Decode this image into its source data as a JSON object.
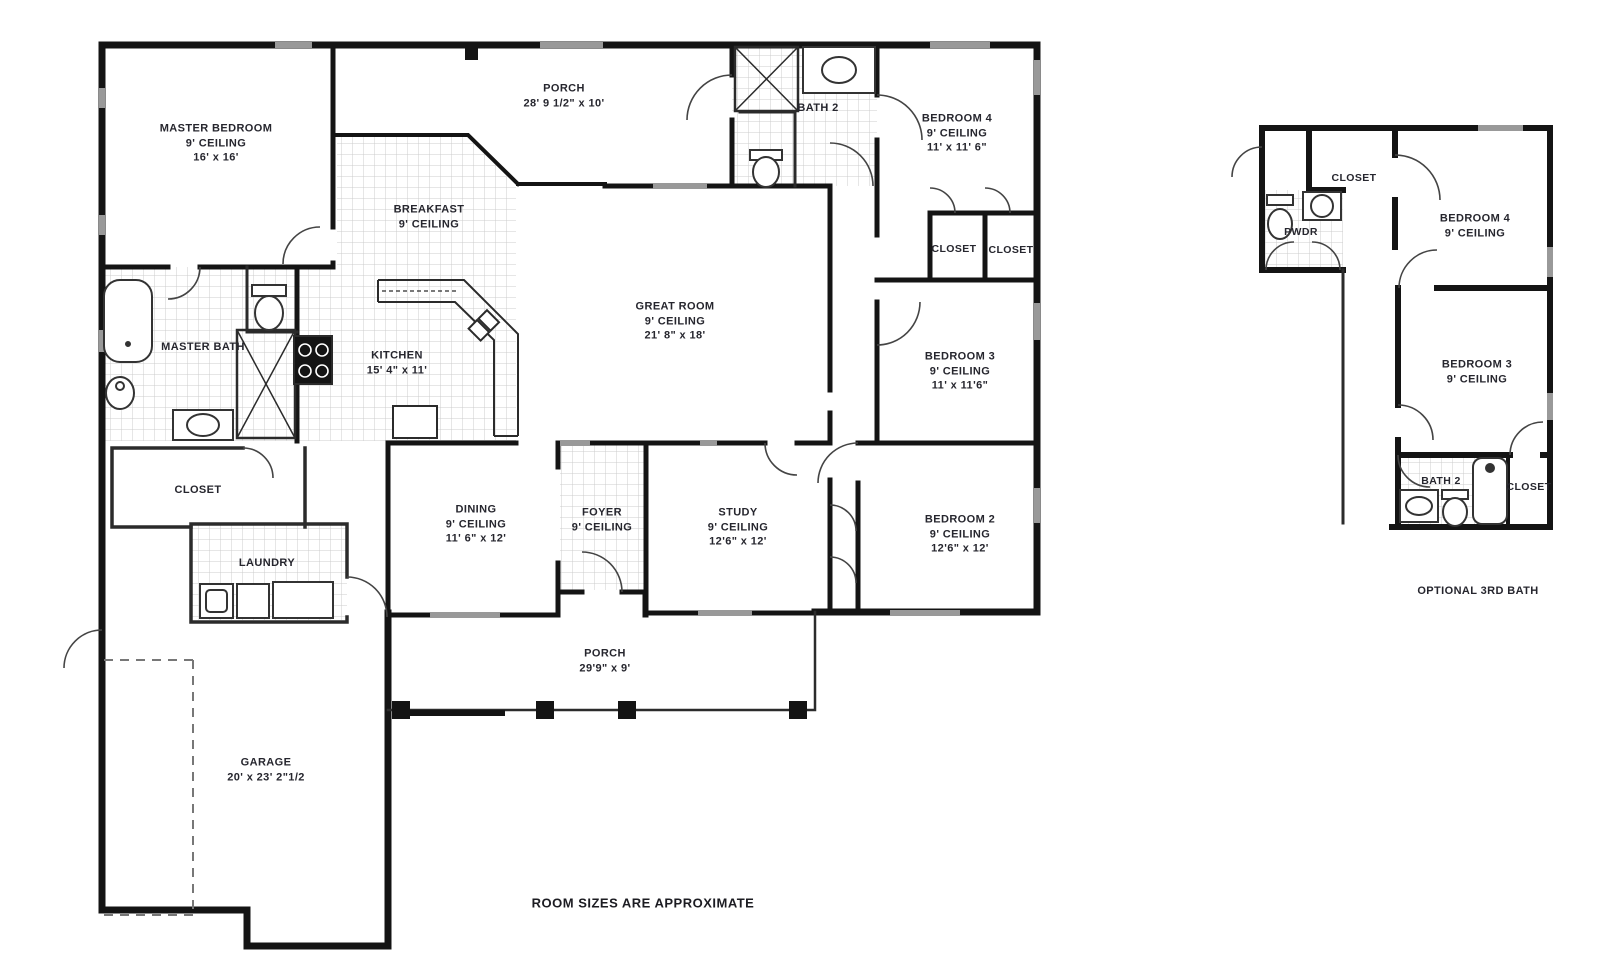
{
  "footnote": "ROOM SIZES ARE APPROXIMATE",
  "main_plan": {
    "master_bedroom": {
      "name": "MASTER BEDROOM",
      "ceiling": "9' CEILING",
      "size": "16' x 16'"
    },
    "porch_top": {
      "name": "PORCH",
      "size": "28' 9 1/2\" x 10'"
    },
    "bath_2": {
      "name": "BATH 2"
    },
    "bedroom_4": {
      "name": "BEDROOM 4",
      "ceiling": "9' CEILING",
      "size": "11' x 11' 6\""
    },
    "breakfast": {
      "name": "BREAKFAST",
      "ceiling": "9' CEILING"
    },
    "great_room": {
      "name": "GREAT ROOM",
      "ceiling": "9' CEILING",
      "size": "21' 8\" x 18'"
    },
    "closet_1": {
      "name": "CLOSET"
    },
    "closet_2": {
      "name": "CLOSET"
    },
    "master_bath": {
      "name": "MASTER BATH"
    },
    "kitchen": {
      "name": "KITCHEN",
      "size": "15' 4\" x 11'"
    },
    "bedroom_3": {
      "name": "BEDROOM 3",
      "ceiling": "9' CEILING",
      "size": "11' x 11'6\""
    },
    "master_closet": {
      "name": "CLOSET"
    },
    "laundry": {
      "name": "LAUNDRY"
    },
    "dining": {
      "name": "DINING",
      "ceiling": "9' CEILING",
      "size": "11' 6\" x 12'"
    },
    "foyer": {
      "name": "FOYER",
      "ceiling": "9' CEILING"
    },
    "study": {
      "name": "STUDY",
      "ceiling": "9' CEILING",
      "size": "12'6\" x 12'"
    },
    "bedroom_2": {
      "name": "BEDROOM 2",
      "ceiling": "9' CEILING",
      "size": "12'6\" x 12'"
    },
    "porch_bottom": {
      "name": "PORCH",
      "size": "29'9\" x 9'"
    },
    "garage": {
      "name": "GARAGE",
      "size": "20' x 23' 2\"1/2"
    }
  },
  "optional_plan": {
    "caption": "OPTIONAL 3RD BATH",
    "closet_top": {
      "name": "CLOSET"
    },
    "pwdr": {
      "name": "PWDR"
    },
    "bedroom_4": {
      "name": "BEDROOM 4",
      "ceiling": "9' CEILING"
    },
    "bedroom_3": {
      "name": "BEDROOM 3",
      "ceiling": "9' CEILING"
    },
    "bath_2": {
      "name": "BATH 2"
    },
    "closet_bottom": {
      "name": "CLOSET"
    }
  },
  "colors": {
    "walls": "#141414",
    "windows": "#999999",
    "tile_line": "#c9c9c9",
    "text": "#26262e"
  }
}
